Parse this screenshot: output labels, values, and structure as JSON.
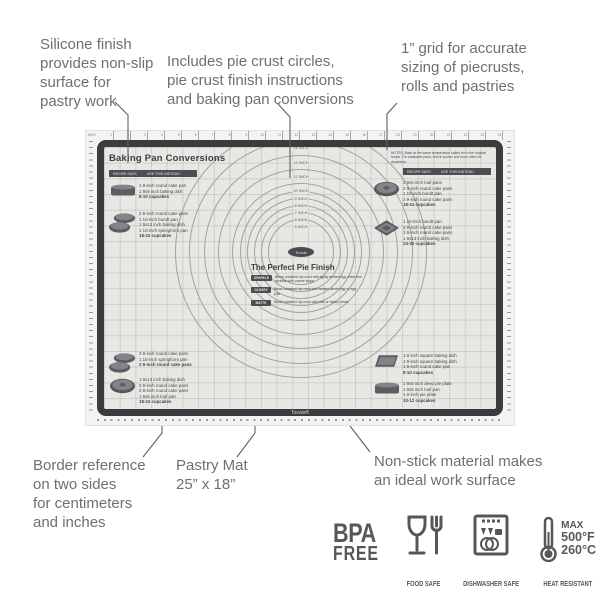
{
  "callouts": [
    {
      "id": "silicone",
      "text": "Silicone finish\nprovides non-slip\nsurface for\npastry work"
    },
    {
      "id": "includes",
      "text": "Includes pie crust circles,\npie crust finish instructions\nand baking pan conversions"
    },
    {
      "id": "grid",
      "text": "1” grid for accurate\nsizing of piecrusts,\nrolls and pastries"
    },
    {
      "id": "border",
      "text": "Border reference\non two sides\nfor centimeters\nand inches"
    },
    {
      "id": "size",
      "text": "Pastry Mat\n25” x 18”"
    },
    {
      "id": "nonstick",
      "text": "Non-stick material makes\nan ideal work surface"
    }
  ],
  "mat": {
    "brand_center": "Tovolo",
    "brand_border": "Tovolo®",
    "rulers": {
      "inch_label": "INCH",
      "top_numbers": [
        1,
        2,
        3,
        4,
        5,
        6,
        7,
        8,
        9,
        10,
        11,
        12,
        13,
        14,
        15,
        16,
        17,
        18,
        19,
        20,
        21,
        22,
        23,
        24
      ]
    },
    "pie_circles": [
      {
        "label": "18 INCH",
        "r": 126
      },
      {
        "label": "16 INCH",
        "r": 112
      },
      {
        "label": "14 INCH",
        "r": 97
      },
      {
        "label": "12 INCH",
        "r": 83
      },
      {
        "label": "10 INCH",
        "r": 69
      },
      {
        "label": "9 INCH",
        "r": 61
      },
      {
        "label": "8 INCH",
        "r": 54
      },
      {
        "label": "7 INCH",
        "r": 47
      },
      {
        "label": "6 INCH",
        "r": 40
      },
      {
        "label": "5 INCH",
        "r": 33
      }
    ],
    "pan_conversions": {
      "title": "Baking Pan Conversions",
      "header_left": "RECIPE SAYS",
      "header_right": "USE THIS INSTEAD",
      "notes": "NOTES: Bake at the same temperature called for in the original recipe. For shallower pans, check sooner and more often for doneness.",
      "entries": [
        {
          "id": "e1",
          "icon": "loaf",
          "lines": [
            "1 8-inch round cake pan",
            "1 9x9 inch baking dish",
            "8-10 cupcakes"
          ]
        },
        {
          "id": "e2",
          "icon": "rounds2",
          "lines": [
            "2 8-inch round cake pans",
            "1 10-inch bundt pan",
            "1 9x13 inch baking dish",
            "1 10-inch springform pan",
            "18-24 cupcakes"
          ]
        },
        {
          "id": "e3",
          "icon": "rounds2",
          "lines": [
            "2 8-inch round cake pans",
            "1 10-inch springform pan",
            "2 9-inch round cake pans"
          ]
        },
        {
          "id": "e4",
          "icon": "bundt",
          "lines": [
            "1 9x13 inch baking dish",
            "2 9-inch round cake pans",
            "2 8-inch round cake pans",
            "1 9x5 inch loaf pan",
            "18-24 cupcakes"
          ]
        },
        {
          "id": "e5",
          "icon": "bundt",
          "lines": [
            "2 9x5 inch loaf pans",
            "2 8-inch round cake pans",
            "1 10-inch bundt pan",
            "2 9-inch round cake pans",
            "18-24 cupcakes"
          ]
        },
        {
          "id": "e6",
          "icon": "diamond",
          "lines": [
            "1 10-inch bundt pan",
            "2 9-inch round cake pans",
            "2 8-inch round cake pans",
            "1 9x13 inch baking dish",
            "24-30 cupcakes"
          ]
        },
        {
          "id": "e7",
          "icon": "square",
          "lines": [
            "1 8-inch square baking dish",
            "1 9-inch square baking dish",
            "1 9-inch round cake pan",
            "8-10 cupcakes"
          ]
        },
        {
          "id": "e8",
          "icon": "loaf",
          "lines": [
            "1 9x5 inch deep pie plate",
            "1 9x5 inch loaf pan",
            "1 8-inch pie plate",
            "10-12 cupcakes"
          ]
        }
      ]
    },
    "pie_finish": {
      "title": "The Perfect Pie Finish",
      "rows": [
        {
          "chip": "SPARKLE",
          "text": "Brush unbaked top crust with lightly beaten egg white and sprinkle with coarse sugar"
        },
        {
          "chip": "GLOSSY",
          "text": "Brush unbaked top crust with beaten whole egg or egg yolk"
        },
        {
          "chip": "MATTE",
          "text": "Brush unbaked top crust with milk or heavy cream"
        }
      ]
    }
  },
  "badges": {
    "bpa": {
      "line1": "BPA",
      "line2": "FREE"
    },
    "food_safe": {
      "caption": "FOOD SAFE"
    },
    "dishwasher": {
      "caption": "DISHWASHER SAFE"
    },
    "heat": {
      "max": "MAX",
      "fahrenheit": "500°F",
      "celsius": "260°C",
      "caption": "HEAT RESISTANT"
    }
  },
  "colors": {
    "annotation_text": "#6e6f72",
    "mat_frame": "#3b3b3d",
    "mat_surface": "#e8e7e3",
    "badge_gray": "#56575a",
    "bar_dark": "#4d4e51"
  }
}
